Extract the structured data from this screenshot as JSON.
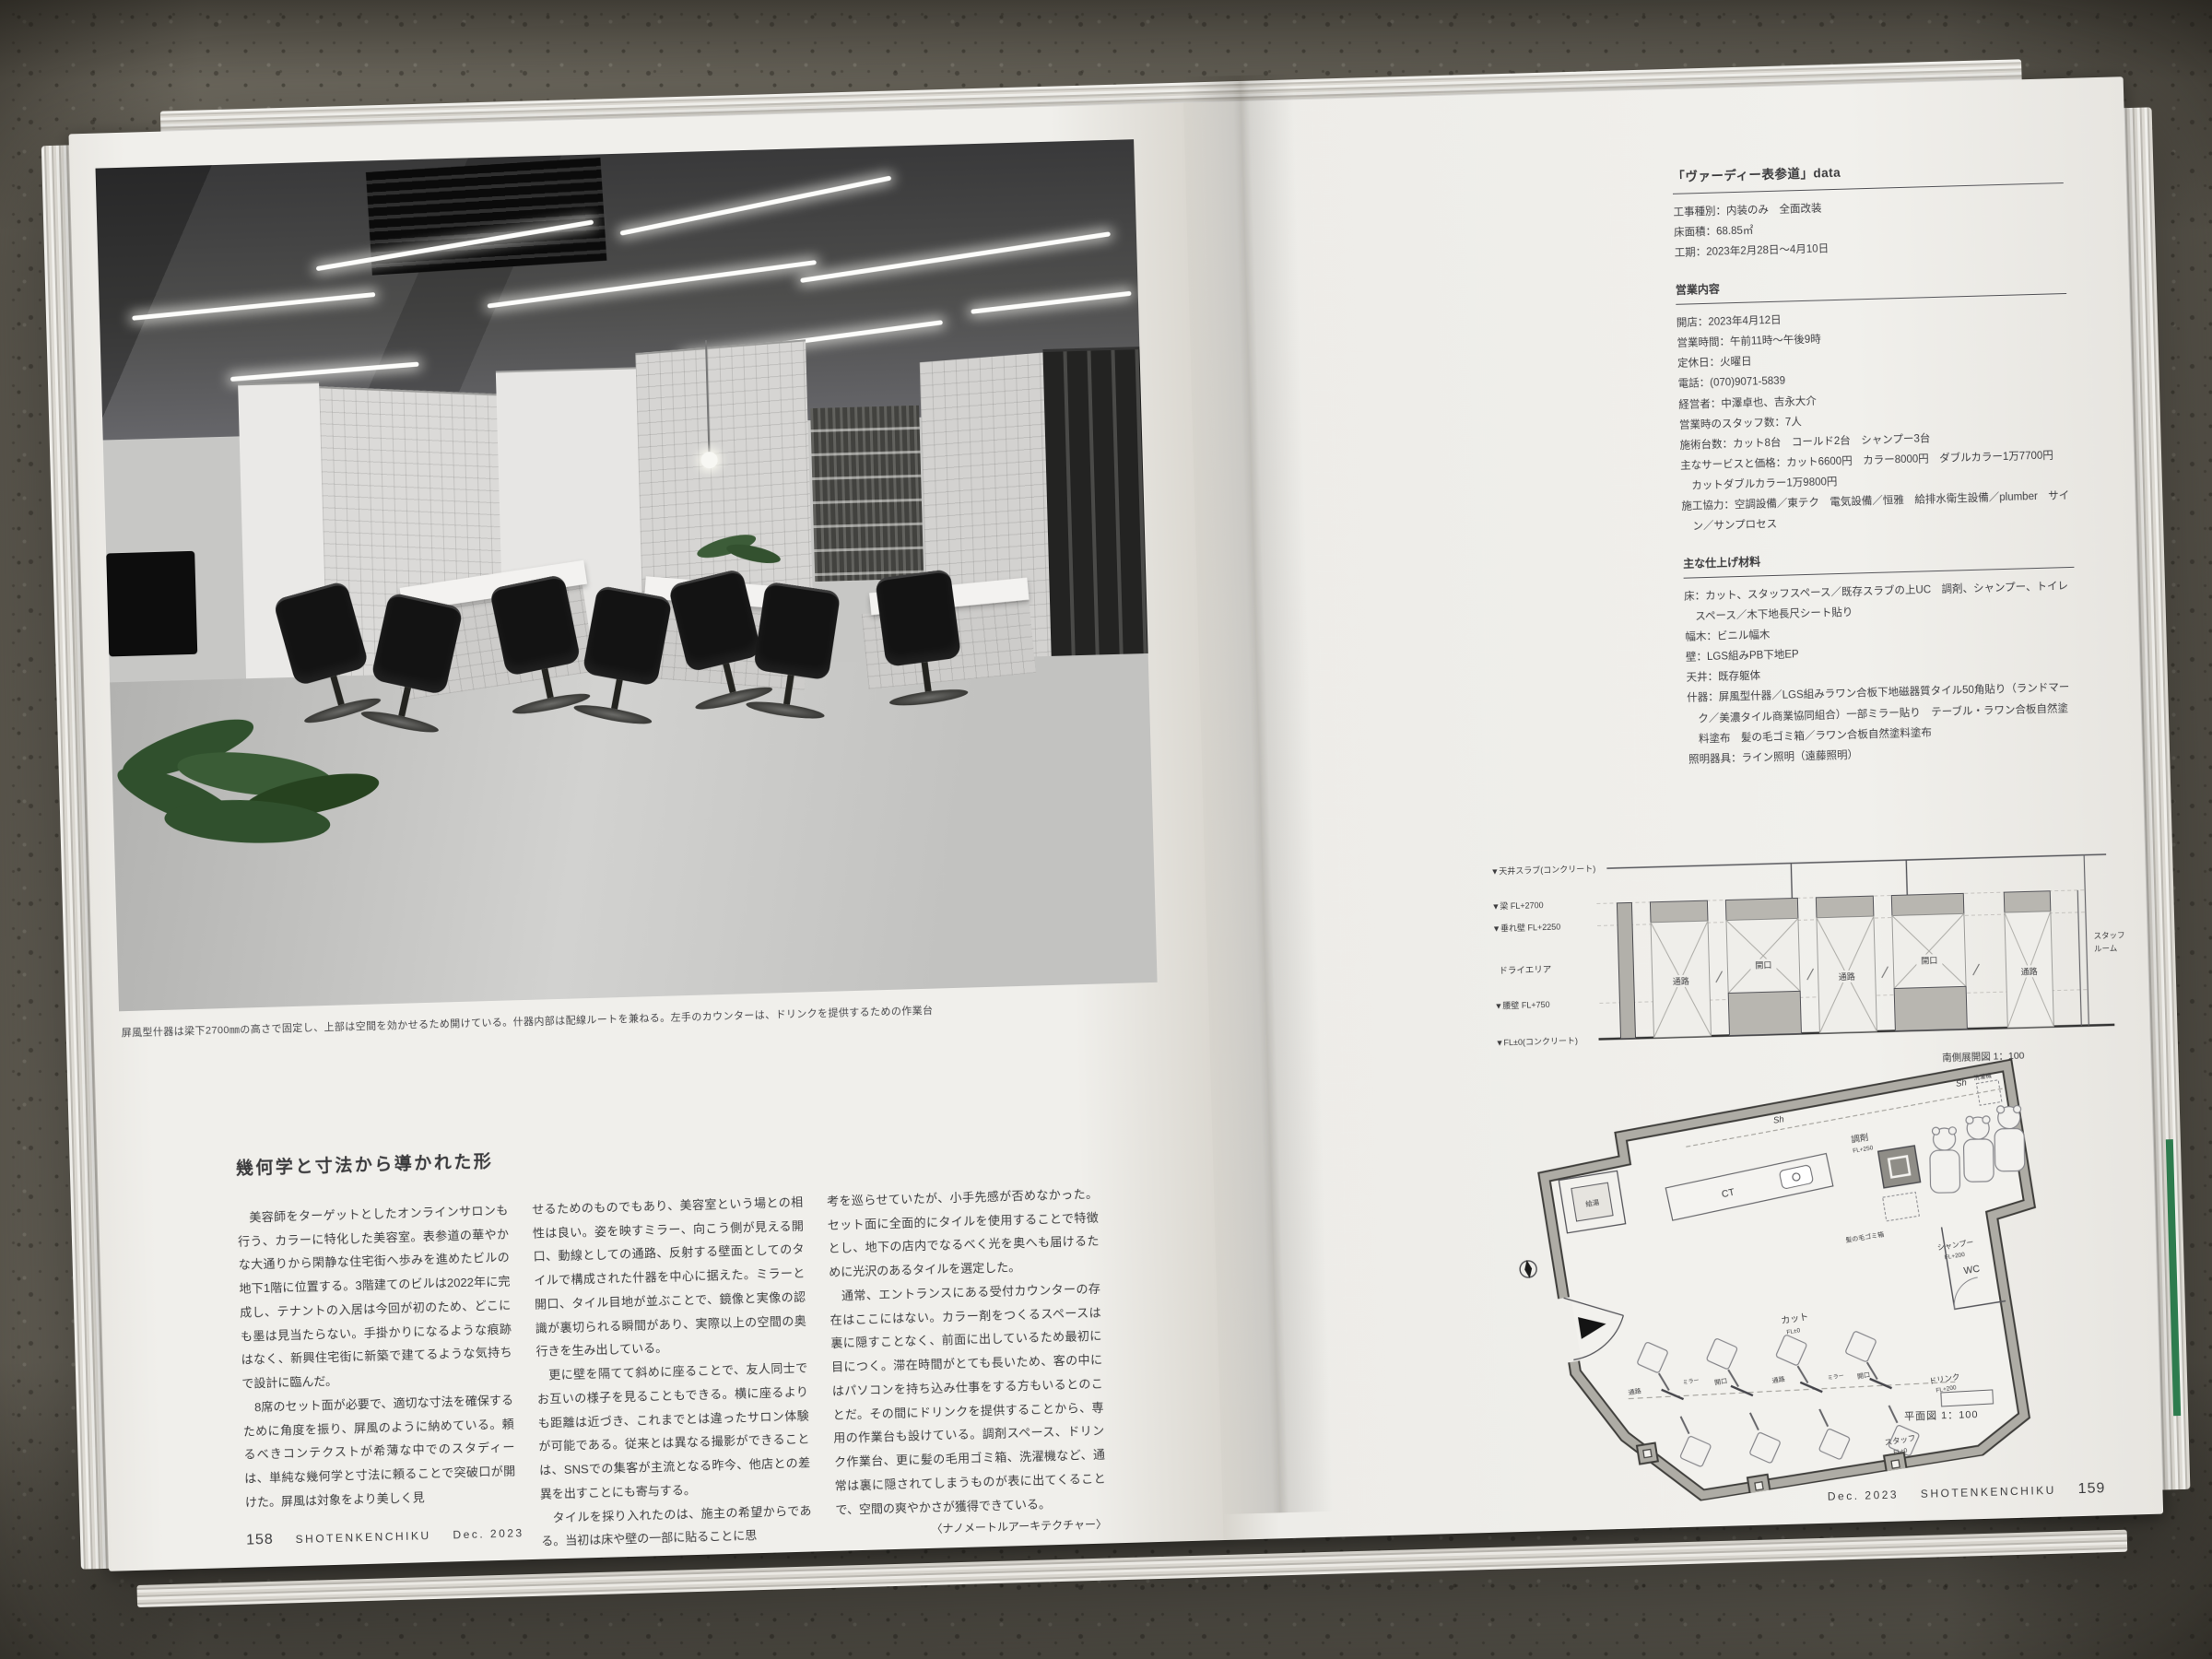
{
  "photo_caption": "屏風型什器は梁下2700㎜の高さで固定し、上部は空間を効かせるため開けている。什器内部は配線ルートを兼ねる。左手のカウンターは、ドリンクを提供するための作業台",
  "article": {
    "heading": "幾何学と寸法から導かれた形",
    "c1p1": "美容師をターゲットとしたオンラインサロンも行う、カラーに特化した美容室。表参道の華やかな大通りから閑静な住宅街へ歩みを進めたビルの地下1階に位置する。3階建てのビルは2022年に完成し、テナントの入居は今回が初のため、どこにも墨は見当たらない。手掛かりになるような痕跡はなく、新興住宅街に新築で建てるような気持ちで設計に臨んだ。",
    "c1p2": "8席のセット面が必要で、適切な寸法を確保するために角度を振り、屏風のように納めている。頼るべきコンテクストが希薄な中でのスタディーは、単純な幾何学と寸法に頼ることで突破口が開けた。屏風は対象をより美しく見",
    "c2p1": "せるためのものでもあり、美容室という場との相性は良い。姿を映すミラー、向こう側が見える開口、動線としての通路、反射する壁面としてのタイルで構成された什器を中心に据えた。ミラーと開口、タイル目地が並ぶことで、鏡像と実像の認識が裏切られる瞬間があり、実際以上の空間の奥行きを生み出している。",
    "c2p2": "更に壁を隔てて斜めに座ることで、友人同士でお互いの様子を見ることもできる。横に座るよりも距離は近づき、これまでとは違ったサロン体験が可能である。従来とは異なる撮影ができることは、SNSでの集客が主流となる昨今、他店との差異を出すことにも寄与する。",
    "c2p3": "タイルを採り入れたのは、施主の希望からである。当初は床や壁の一部に貼ることに思",
    "c3p1": "考を巡らせていたが、小手先感が否めなかった。セット面に全面的にタイルを使用することで特徴とし、地下の店内でなるべく光を奥へも届けるために光沢のあるタイルを選定した。",
    "c3p2": "通常、エントランスにある受付カウンターの存在はここにはない。カラー剤をつくるスペースは裏に隠すことなく、前面に出しているため最初に目につく。滞在時間がとても長いため、客の中にはパソコンを持ち込み仕事をする方もいるとのことだ。その間にドリンクを提供することから、専用の作業台も設けている。調剤スペース、ドリンク作業台、更に髪の毛用ゴミ箱、洗濯機など、通常は裏に隠されてしまうものが表に出てくることで、空間の爽やかさが獲得できている。",
    "byline": "〈ナノメートルアーキテクチャー〉"
  },
  "panel": {
    "title": "「ヴァーディー表参道」data",
    "s1": [
      "工事種別：内装のみ　全面改装",
      "床面積：68.85㎡",
      "工期：2023年2月28日～4月10日"
    ],
    "h2": "営業内容",
    "s2": [
      "開店：2023年4月12日",
      "営業時間：午前11時～午後9時",
      "定休日：火曜日",
      "電話：(070)9071-5839",
      "経営者：中澤卓也、吉永大介",
      "営業時のスタッフ数：7人",
      "施術台数：カット8台　コールド2台　シャンプー3台",
      "主なサービスと価格：カット6600円　カラー8000円　ダブルカラー1万7700円　カットダブルカラー1万9800円",
      "施工協力：空調設備／東テク　電気設備／恒雅　給排水衛生設備／plumber　サイン／サンプロセス"
    ],
    "h3": "主な仕上げ材料",
    "s3": [
      "床：カット、スタッフスペース／既存スラブの上UC　調剤、シャンプー、トイレスペース／木下地長尺シート貼り",
      "幅木：ビニル幅木",
      "壁：LGS組みPB下地EP",
      "天井：既存躯体",
      "什器：屏風型什器／LGS組みラワン合板下地磁器質タイル50角貼り（ランドマーク／美濃タイル商業協同組合）一部ミラー貼り　テーブル・ラワン合板自然塗料塗布　髪の毛ゴミ箱／ラワン合板自然塗料塗布",
      "照明器具：ライン照明（遠藤照明）"
    ]
  },
  "section": {
    "levels": [
      "▼天井スラブ(コンクリート)",
      "▼梁 FL+2700",
      "▼垂れ壁 FL+2250",
      "▼腰壁 FL+750",
      "▼FL±0(コンクリート)"
    ],
    "dry_area": "ドライエリア",
    "bays": [
      "通路",
      "開口",
      "通路",
      "開口",
      "通路"
    ],
    "staff1": "スタッフ",
    "staff2": "ルーム",
    "caption": "南側展開図 1：100"
  },
  "plan": {
    "sh": "Sh",
    "kyuto": "給湯",
    "ct": "CT",
    "chozai": "調剤",
    "chozai_fl": "FL+250",
    "gomi": "髪の毛ゴミ箱",
    "wash": "洗濯機",
    "wc": "WC",
    "shampoo": "シャンプー",
    "shampoo_fl": "FL+200",
    "cut": "カット",
    "cut_fl": "FL±0",
    "tsuro": "通路",
    "kaiko": "開口",
    "mirror": "ミラー",
    "drink": "ドリンク",
    "drink_fl": "FL+200",
    "staff": "スタッフ",
    "staff_fl": "FL±0",
    "caption": "平面図 1：100"
  },
  "footer_left": {
    "num": "158",
    "mag": "SHOTENKENCHIKU",
    "issue": "Dec. 2023"
  },
  "footer_right": {
    "issue": "Dec. 2023",
    "mag": "SHOTENKENCHIKU",
    "num": "159"
  }
}
